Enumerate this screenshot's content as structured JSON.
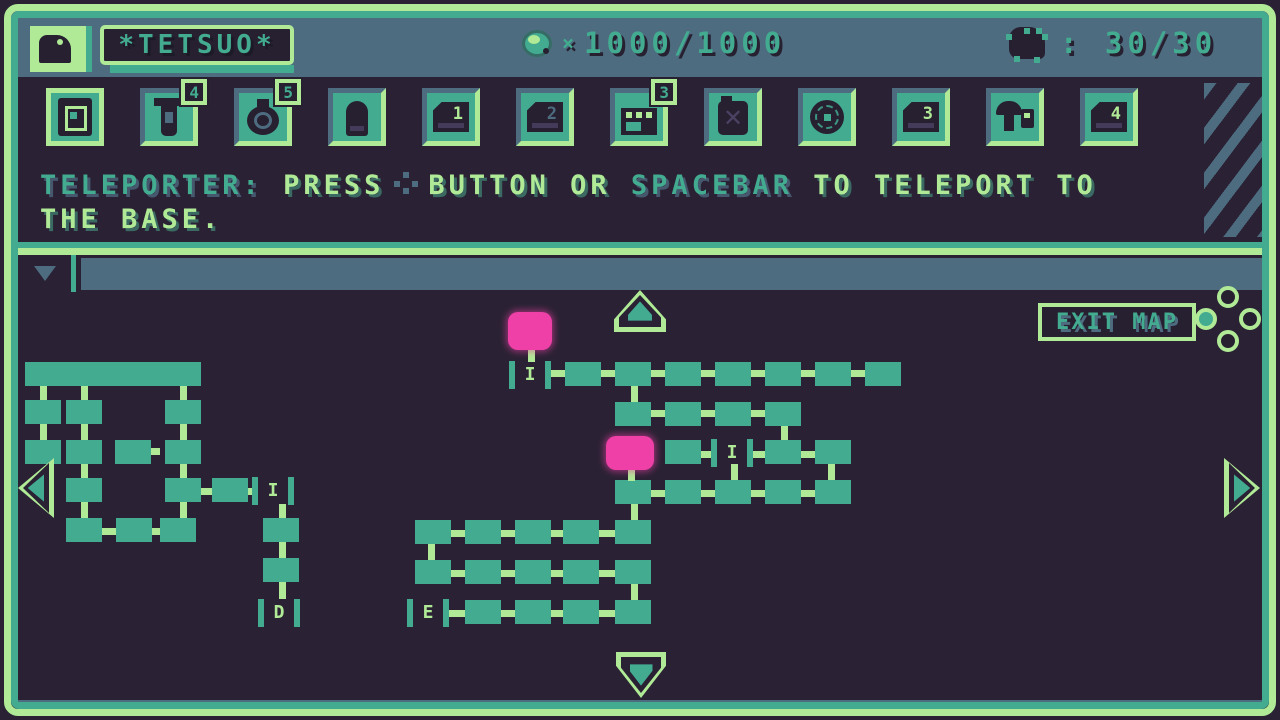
{
  "colors": {
    "background": "#2a2234",
    "green": "#b0ea96",
    "teal": "#42ab90",
    "slate": "#4d6c80",
    "pink": "#ef40a7",
    "icon_dark": "#272030"
  },
  "header": {
    "player_name": "*TETSUO*",
    "ammo_multiplier": "×",
    "ammo_value": "1000/1000",
    "enemy_value": ": 30/30"
  },
  "inventory": {
    "slots": [
      {
        "id": "teleporter-chip",
        "icon": "chip",
        "selected": true
      },
      {
        "id": "syringe",
        "icon": "syringe",
        "badge": "4"
      },
      {
        "id": "stopwatch",
        "icon": "watch",
        "badge": "5"
      },
      {
        "id": "bullet",
        "icon": "bullet"
      },
      {
        "id": "disk-1",
        "icon": "disk",
        "num": "1",
        "numColor": "green"
      },
      {
        "id": "disk-2",
        "icon": "disk",
        "num": "2",
        "numColor": "slate"
      },
      {
        "id": "register",
        "icon": "register",
        "badge": "3"
      },
      {
        "id": "canister",
        "icon": "can"
      },
      {
        "id": "web-orb",
        "icon": "web"
      },
      {
        "id": "disk-3",
        "icon": "disk",
        "num": "3",
        "numColor": "green"
      },
      {
        "id": "mushroom-kit",
        "icon": "mush"
      },
      {
        "id": "disk-4",
        "icon": "disk",
        "num": "4",
        "numColor": "green"
      }
    ]
  },
  "message": {
    "line1": [
      {
        "text": "TELEPORTER:",
        "color": "teal"
      },
      {
        "text": " PRESS",
        "color": "green"
      },
      {
        "icon": "button-dots"
      },
      {
        "text": "BUTTON OR ",
        "color": "green"
      },
      {
        "text": "SPACEBAR",
        "color": "teal"
      },
      {
        "text": " TO TELEPORT TO",
        "color": "green"
      }
    ],
    "line2": [
      {
        "text": "THE BASE.",
        "color": "green"
      }
    ]
  },
  "map": {
    "exit_label": "EXIT MAP",
    "rooms": [
      [
        25,
        362,
        176,
        24
      ],
      [
        25,
        400,
        36,
        24
      ],
      [
        66,
        400,
        36,
        24
      ],
      [
        165,
        400,
        36,
        24
      ],
      [
        25,
        440,
        36,
        24
      ],
      [
        66,
        440,
        36,
        24
      ],
      [
        115,
        440,
        36,
        24
      ],
      [
        165,
        440,
        36,
        24
      ],
      [
        66,
        478,
        36,
        24
      ],
      [
        165,
        478,
        36,
        24
      ],
      [
        212,
        478,
        36,
        24
      ],
      [
        66,
        518,
        36,
        24
      ],
      [
        116,
        518,
        36,
        24
      ],
      [
        160,
        518,
        36,
        24
      ],
      [
        263,
        518,
        36,
        24
      ],
      [
        263,
        558,
        36,
        24
      ],
      [
        565,
        362,
        36,
        24
      ],
      [
        615,
        362,
        36,
        24
      ],
      [
        665,
        362,
        36,
        24
      ],
      [
        715,
        362,
        36,
        24
      ],
      [
        765,
        362,
        36,
        24
      ],
      [
        815,
        362,
        36,
        24
      ],
      [
        865,
        362,
        36,
        24
      ],
      [
        615,
        402,
        36,
        24
      ],
      [
        665,
        402,
        36,
        24
      ],
      [
        715,
        402,
        36,
        24
      ],
      [
        765,
        402,
        36,
        24
      ],
      [
        665,
        440,
        36,
        24
      ],
      [
        765,
        440,
        36,
        24
      ],
      [
        815,
        440,
        36,
        24
      ],
      [
        615,
        480,
        36,
        24
      ],
      [
        665,
        480,
        36,
        24
      ],
      [
        715,
        480,
        36,
        24
      ],
      [
        765,
        480,
        36,
        24
      ],
      [
        815,
        480,
        36,
        24
      ],
      [
        415,
        520,
        36,
        24
      ],
      [
        465,
        520,
        36,
        24
      ],
      [
        515,
        520,
        36,
        24
      ],
      [
        563,
        520,
        36,
        24
      ],
      [
        615,
        520,
        36,
        24
      ],
      [
        415,
        560,
        36,
        24
      ],
      [
        465,
        560,
        36,
        24
      ],
      [
        515,
        560,
        36,
        24
      ],
      [
        563,
        560,
        36,
        24
      ],
      [
        615,
        560,
        36,
        24
      ],
      [
        465,
        600,
        36,
        24
      ],
      [
        515,
        600,
        36,
        24
      ],
      [
        563,
        600,
        36,
        24
      ],
      [
        615,
        600,
        36,
        24
      ]
    ],
    "links": [
      [
        40,
        386,
        7,
        14
      ],
      [
        81,
        386,
        7,
        14
      ],
      [
        180,
        386,
        7,
        14
      ],
      [
        40,
        424,
        7,
        16
      ],
      [
        81,
        424,
        7,
        16
      ],
      [
        180,
        424,
        7,
        16
      ],
      [
        81,
        464,
        7,
        14
      ],
      [
        180,
        464,
        7,
        14
      ],
      [
        81,
        502,
        7,
        16
      ],
      [
        180,
        502,
        7,
        16
      ],
      [
        151,
        448,
        9,
        7
      ],
      [
        201,
        488,
        11,
        7
      ],
      [
        248,
        488,
        8,
        7
      ],
      [
        102,
        528,
        14,
        7
      ],
      [
        152,
        528,
        8,
        7
      ],
      [
        279,
        504,
        7,
        14
      ],
      [
        279,
        542,
        7,
        16
      ],
      [
        279,
        582,
        7,
        17
      ],
      [
        547,
        370,
        18,
        7
      ],
      [
        601,
        370,
        14,
        7
      ],
      [
        651,
        370,
        14,
        7
      ],
      [
        701,
        370,
        14,
        7
      ],
      [
        751,
        370,
        14,
        7
      ],
      [
        801,
        370,
        14,
        7
      ],
      [
        851,
        370,
        14,
        7
      ],
      [
        528,
        348,
        7,
        14
      ],
      [
        631,
        386,
        7,
        16
      ],
      [
        651,
        410,
        14,
        7
      ],
      [
        701,
        410,
        14,
        7
      ],
      [
        751,
        410,
        14,
        7
      ],
      [
        781,
        426,
        7,
        14
      ],
      [
        701,
        451,
        14,
        7
      ],
      [
        751,
        451,
        14,
        7
      ],
      [
        801,
        451,
        14,
        7
      ],
      [
        731,
        464,
        7,
        16
      ],
      [
        828,
        464,
        7,
        16
      ],
      [
        628,
        468,
        7,
        13
      ],
      [
        651,
        490,
        14,
        7
      ],
      [
        701,
        490,
        14,
        7
      ],
      [
        751,
        490,
        14,
        7
      ],
      [
        801,
        490,
        14,
        7
      ],
      [
        631,
        504,
        7,
        16
      ],
      [
        451,
        530,
        14,
        7
      ],
      [
        501,
        530,
        14,
        7
      ],
      [
        551,
        530,
        12,
        7
      ],
      [
        599,
        530,
        16,
        7
      ],
      [
        428,
        544,
        7,
        16
      ],
      [
        451,
        570,
        14,
        7
      ],
      [
        501,
        570,
        14,
        7
      ],
      [
        551,
        570,
        12,
        7
      ],
      [
        599,
        570,
        16,
        7
      ],
      [
        631,
        584,
        7,
        16
      ],
      [
        449,
        610,
        16,
        7
      ],
      [
        501,
        610,
        14,
        7
      ],
      [
        551,
        610,
        12,
        7
      ],
      [
        599,
        610,
        16,
        7
      ]
    ],
    "doors": [
      [
        252,
        477,
        "I"
      ],
      [
        258,
        599,
        "D"
      ],
      [
        509,
        361,
        "I"
      ],
      [
        711,
        439,
        "I"
      ],
      [
        407,
        599,
        "E"
      ]
    ],
    "pins": [
      [
        508,
        312,
        44,
        38
      ],
      [
        606,
        436,
        48,
        34
      ]
    ]
  }
}
